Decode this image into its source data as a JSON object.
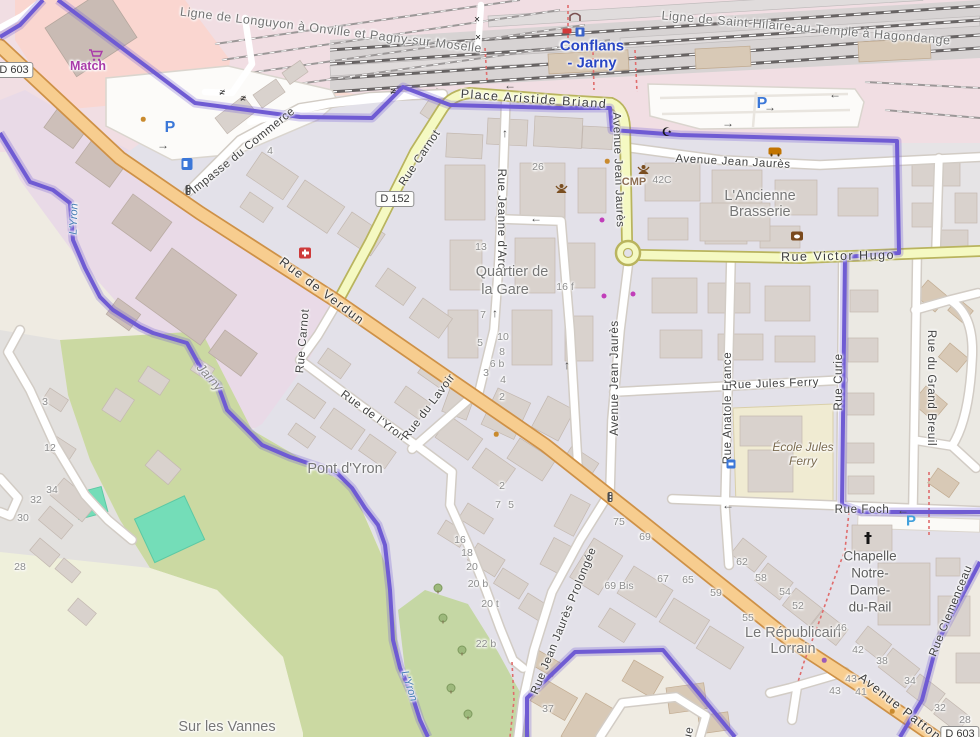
{
  "map": {
    "region": "Conflans-Jarny railway station area",
    "colors": {
      "boundary": "#6F5BD3",
      "primary_road": "#F7CD8F",
      "secondary_road": "#F5F9C2",
      "residential": "#E3E1E9",
      "industrial": "#E9DAE7",
      "retail_pink": "#FAD6D0",
      "scrub": "#CBD9A2",
      "pitch": "#74DDB8",
      "water_label": "#4A80B5",
      "station_name": "#2946C4",
      "parking": "#3B77D8"
    },
    "labels": [
      {
        "t": "Ligne de Longuyon à Onville et Pagny-sur-Moselle",
        "x": 331,
        "y": 30,
        "r": 7,
        "c": "rail"
      },
      {
        "t": "Ligne de Saint-Hilaire-au-Temple à Hagondange",
        "x": 806,
        "y": 28,
        "r": 5,
        "c": "rail"
      },
      {
        "t": "Conflans",
        "x": 592,
        "y": 46,
        "r": 0,
        "c": "station"
      },
      {
        "t": "- Jarny",
        "x": 592,
        "y": 63,
        "r": 0,
        "c": "station"
      },
      {
        "t": "Place Aristide Briand",
        "x": 534,
        "y": 99,
        "r": 4,
        "c": "street-big"
      },
      {
        "t": "Avenue Jean Jaurès",
        "x": 733,
        "y": 162,
        "r": 3,
        "c": "street"
      },
      {
        "t": "Avenue Jean Jaurès",
        "x": 618,
        "y": 170,
        "r": 88,
        "c": "street"
      },
      {
        "t": "Avenue Jean Jaurès",
        "x": 615,
        "y": 378,
        "r": -90,
        "c": "street"
      },
      {
        "t": "Rue Victor Hugo",
        "x": 838,
        "y": 256,
        "r": -1,
        "c": "street-big"
      },
      {
        "t": "Rue Carnot",
        "x": 420,
        "y": 158,
        "r": -56,
        "c": "street"
      },
      {
        "t": "Rue Carnot",
        "x": 303,
        "y": 341,
        "r": -85,
        "c": "street"
      },
      {
        "t": "Rue de Verdun",
        "x": 322,
        "y": 291,
        "r": 37,
        "c": "street-big"
      },
      {
        "t": "Impasse du Commerce",
        "x": 243,
        "y": 151,
        "r": -39,
        "c": "street"
      },
      {
        "t": "Rue Jeanne d'Arc",
        "x": 501,
        "y": 219,
        "r": 90,
        "c": "street"
      },
      {
        "t": "Rue de l'Yron",
        "x": 373,
        "y": 416,
        "r": 36,
        "c": "street"
      },
      {
        "t": "Rue du Lavoir",
        "x": 429,
        "y": 407,
        "r": -53,
        "c": "street"
      },
      {
        "t": "Rue Jean Jaurès Prolongée",
        "x": 564,
        "y": 621,
        "r": -68,
        "c": "street"
      },
      {
        "t": "Rue Jules Ferry",
        "x": 774,
        "y": 384,
        "r": -2,
        "c": "street"
      },
      {
        "t": "Rue Anatole France",
        "x": 728,
        "y": 408,
        "r": -90,
        "c": "street"
      },
      {
        "t": "Rue du Grand Breuil",
        "x": 931,
        "y": 388,
        "r": 90,
        "c": "street"
      },
      {
        "t": "Rue Curie",
        "x": 839,
        "y": 382,
        "r": -90,
        "c": "street"
      },
      {
        "t": "Rue Foch",
        "x": 862,
        "y": 510,
        "r": 0,
        "c": "street"
      },
      {
        "t": "Avenue Patton",
        "x": 900,
        "y": 707,
        "r": 38,
        "c": "street-big"
      },
      {
        "t": "Rue Clemenceau",
        "x": 951,
        "y": 611,
        "r": -68,
        "c": "street"
      },
      {
        "t": "Rue",
        "x": 688,
        "y": 738,
        "r": -78,
        "c": "street"
      },
      {
        "t": "Quartier de",
        "x": 512,
        "y": 272,
        "r": 0,
        "c": "place"
      },
      {
        "t": "la Gare",
        "x": 505,
        "y": 290,
        "r": 0,
        "c": "place"
      },
      {
        "t": "L'Ancienne",
        "x": 760,
        "y": 196,
        "r": 0,
        "c": "place"
      },
      {
        "t": "Brasserie",
        "x": 760,
        "y": 212,
        "r": 0,
        "c": "place"
      },
      {
        "t": "Pont d'Yron",
        "x": 345,
        "y": 469,
        "r": 0,
        "c": "place"
      },
      {
        "t": "Le Républicain",
        "x": 793,
        "y": 633,
        "r": 0,
        "c": "place"
      },
      {
        "t": "Lorrain",
        "x": 793,
        "y": 649,
        "r": 0,
        "c": "place"
      },
      {
        "t": "Sur les Vannes",
        "x": 227,
        "y": 727,
        "r": 0,
        "c": "place"
      },
      {
        "t": "École Jules",
        "x": 803,
        "y": 447,
        "r": 0,
        "c": "school"
      },
      {
        "t": "Ferry",
        "x": 803,
        "y": 461,
        "r": 0,
        "c": "school"
      },
      {
        "t": "Chapelle",
        "x": 870,
        "y": 556,
        "r": 0,
        "c": "chapel"
      },
      {
        "t": "Notre-",
        "x": 870,
        "y": 573,
        "r": 0,
        "c": "chapel"
      },
      {
        "t": "Dame-",
        "x": 870,
        "y": 590,
        "r": 0,
        "c": "chapel"
      },
      {
        "t": "du-Rail",
        "x": 870,
        "y": 607,
        "r": 0,
        "c": "chapel"
      },
      {
        "t": "Jarny",
        "x": 210,
        "y": 377,
        "r": 48,
        "c": "boundary-name"
      },
      {
        "t": "L'Yron",
        "x": 74,
        "y": 219,
        "r": -88,
        "c": "water"
      },
      {
        "t": "L'Yron",
        "x": 409,
        "y": 686,
        "r": 72,
        "c": "water"
      },
      {
        "t": "Match",
        "x": 88,
        "y": 66,
        "r": 0,
        "c": "shop-name"
      },
      {
        "t": "CMP",
        "x": 634,
        "y": 182,
        "r": 0,
        "c": "amenity-name"
      },
      {
        "t": "42C",
        "x": 662,
        "y": 180,
        "r": 0,
        "c": "num"
      },
      {
        "t": "4",
        "x": 270,
        "y": 151,
        "r": 0,
        "c": "num"
      },
      {
        "t": "26",
        "x": 538,
        "y": 167,
        "r": 0,
        "c": "num"
      },
      {
        "t": "13",
        "x": 481,
        "y": 247,
        "r": 0,
        "c": "num"
      },
      {
        "t": "16 f",
        "x": 565,
        "y": 287,
        "r": 0,
        "c": "num"
      },
      {
        "t": "7",
        "x": 483,
        "y": 315,
        "r": 0,
        "c": "num"
      },
      {
        "t": "10",
        "x": 503,
        "y": 337,
        "r": 0,
        "c": "num"
      },
      {
        "t": "5",
        "x": 480,
        "y": 343,
        "r": 0,
        "c": "num"
      },
      {
        "t": "8",
        "x": 502,
        "y": 352,
        "r": 0,
        "c": "num"
      },
      {
        "t": "6 b",
        "x": 497,
        "y": 364,
        "r": 0,
        "c": "num"
      },
      {
        "t": "3",
        "x": 486,
        "y": 373,
        "r": 0,
        "c": "num"
      },
      {
        "t": "4",
        "x": 503,
        "y": 380,
        "r": 0,
        "c": "num"
      },
      {
        "t": "2",
        "x": 502,
        "y": 397,
        "r": 0,
        "c": "num"
      },
      {
        "t": "2",
        "x": 502,
        "y": 486,
        "r": 0,
        "c": "num"
      },
      {
        "t": "7",
        "x": 498,
        "y": 505,
        "r": 0,
        "c": "num"
      },
      {
        "t": "5",
        "x": 511,
        "y": 505,
        "r": 0,
        "c": "num"
      },
      {
        "t": "16",
        "x": 460,
        "y": 540,
        "r": 0,
        "c": "num"
      },
      {
        "t": "18",
        "x": 467,
        "y": 553,
        "r": 0,
        "c": "num"
      },
      {
        "t": "20",
        "x": 472,
        "y": 567,
        "r": 0,
        "c": "num"
      },
      {
        "t": "20 b",
        "x": 478,
        "y": 584,
        "r": 0,
        "c": "num"
      },
      {
        "t": "20 t",
        "x": 490,
        "y": 604,
        "r": 0,
        "c": "num"
      },
      {
        "t": "22 b",
        "x": 486,
        "y": 644,
        "r": 0,
        "c": "num"
      },
      {
        "t": "37",
        "x": 548,
        "y": 709,
        "r": 0,
        "c": "num"
      },
      {
        "t": "75",
        "x": 619,
        "y": 522,
        "r": 0,
        "c": "num"
      },
      {
        "t": "69",
        "x": 645,
        "y": 537,
        "r": 0,
        "c": "num"
      },
      {
        "t": "69 Bis",
        "x": 619,
        "y": 586,
        "r": 0,
        "c": "num"
      },
      {
        "t": "67",
        "x": 663,
        "y": 579,
        "r": 0,
        "c": "num"
      },
      {
        "t": "65",
        "x": 688,
        "y": 580,
        "r": 0,
        "c": "num"
      },
      {
        "t": "62",
        "x": 742,
        "y": 562,
        "r": 0,
        "c": "num"
      },
      {
        "t": "58",
        "x": 761,
        "y": 578,
        "r": 0,
        "c": "num"
      },
      {
        "t": "54",
        "x": 785,
        "y": 592,
        "r": 0,
        "c": "num"
      },
      {
        "t": "59",
        "x": 716,
        "y": 593,
        "r": 0,
        "c": "num"
      },
      {
        "t": "52",
        "x": 798,
        "y": 606,
        "r": 0,
        "c": "num"
      },
      {
        "t": "55",
        "x": 748,
        "y": 618,
        "r": 0,
        "c": "num"
      },
      {
        "t": "46",
        "x": 841,
        "y": 628,
        "r": 0,
        "c": "num"
      },
      {
        "t": "42",
        "x": 858,
        "y": 650,
        "r": 0,
        "c": "num"
      },
      {
        "t": "38",
        "x": 882,
        "y": 661,
        "r": 0,
        "c": "num"
      },
      {
        "t": "34",
        "x": 910,
        "y": 681,
        "r": 0,
        "c": "num"
      },
      {
        "t": "43",
        "x": 851,
        "y": 679,
        "r": 0,
        "c": "num"
      },
      {
        "t": "43",
        "x": 835,
        "y": 691,
        "r": 0,
        "c": "num"
      },
      {
        "t": "41",
        "x": 861,
        "y": 692,
        "r": 0,
        "c": "num"
      },
      {
        "t": "32",
        "x": 940,
        "y": 708,
        "r": 0,
        "c": "num"
      },
      {
        "t": "28",
        "x": 965,
        "y": 720,
        "r": 0,
        "c": "num"
      },
      {
        "t": "3",
        "x": 45,
        "y": 402,
        "r": 0,
        "c": "num"
      },
      {
        "t": "12",
        "x": 50,
        "y": 448,
        "r": 0,
        "c": "num"
      },
      {
        "t": "34",
        "x": 52,
        "y": 490,
        "r": 0,
        "c": "num"
      },
      {
        "t": "32",
        "x": 36,
        "y": 500,
        "r": 0,
        "c": "num"
      },
      {
        "t": "30",
        "x": 23,
        "y": 518,
        "r": 0,
        "c": "num"
      },
      {
        "t": "28",
        "x": 20,
        "y": 567,
        "r": 0,
        "c": "num"
      },
      {
        "t": "D 603",
        "x": 14,
        "y": 70,
        "r": 0,
        "c": "shield"
      },
      {
        "t": "D 152",
        "x": 395,
        "y": 199,
        "r": 0,
        "c": "shield"
      },
      {
        "t": "D 603",
        "x": 960,
        "y": 734,
        "r": 0,
        "c": "shield"
      },
      {
        "t": "P",
        "x": 170,
        "y": 128,
        "r": 0,
        "c": "parking"
      },
      {
        "t": "P",
        "x": 762,
        "y": 104,
        "r": 0,
        "c": "parking"
      },
      {
        "t": "P",
        "x": 911,
        "y": 521,
        "r": 0,
        "c": "parking2"
      },
      {
        "t": "×",
        "x": 477,
        "y": 20,
        "r": 0,
        "c": "cross"
      },
      {
        "t": "×",
        "x": 478,
        "y": 38,
        "r": 0,
        "c": "cross"
      },
      {
        "t": "≠",
        "x": 222,
        "y": 93,
        "r": 15,
        "c": "cross"
      },
      {
        "t": "≠",
        "x": 243,
        "y": 99,
        "r": 15,
        "c": "cross"
      },
      {
        "t": "≠",
        "x": 393,
        "y": 92,
        "r": 10,
        "c": "cross"
      },
      {
        "t": "☪",
        "x": 667,
        "y": 132,
        "r": 0,
        "c": "poi-dark"
      },
      {
        "t": "↑",
        "x": 505,
        "y": 133,
        "r": 0,
        "c": "arrow"
      },
      {
        "t": "←",
        "x": 536,
        "y": 218,
        "r": 0,
        "c": "arrow"
      },
      {
        "t": "↑",
        "x": 495,
        "y": 313,
        "r": 0,
        "c": "arrow"
      },
      {
        "t": "↑",
        "x": 567,
        "y": 365,
        "r": 0,
        "c": "arrow"
      },
      {
        "t": "←",
        "x": 510,
        "y": 85,
        "r": 0,
        "c": "arrow"
      },
      {
        "t": "←",
        "x": 835,
        "y": 94,
        "r": 0,
        "c": "arrow"
      },
      {
        "t": "→",
        "x": 770,
        "y": 107,
        "r": 0,
        "c": "arrow"
      },
      {
        "t": "→",
        "x": 728,
        "y": 123,
        "r": 0,
        "c": "arrow"
      },
      {
        "t": "→",
        "x": 163,
        "y": 145,
        "r": 0,
        "c": "arrow"
      },
      {
        "t": "←",
        "x": 728,
        "y": 505,
        "r": 0,
        "c": "arrow"
      },
      {
        "t": "←",
        "x": 903,
        "y": 510,
        "r": 0,
        "c": "arrow"
      }
    ],
    "icons": [
      {
        "n": "fuel-icon",
        "x": 187,
        "y": 164
      },
      {
        "n": "first-aid-icon",
        "x": 305,
        "y": 253
      },
      {
        "n": "traffic-light-icon",
        "x": 188,
        "y": 190
      },
      {
        "n": "traffic-light-icon",
        "x": 610,
        "y": 497
      },
      {
        "n": "bus-stop-icon",
        "x": 731,
        "y": 464
      },
      {
        "n": "community-centre-icon",
        "x": 555,
        "y": 182
      },
      {
        "n": "community-centre-icon",
        "x": 637,
        "y": 163
      },
      {
        "n": "car-shop-icon",
        "x": 775,
        "y": 151
      },
      {
        "n": "attraction-icon",
        "x": 797,
        "y": 236
      },
      {
        "n": "church-cross-icon",
        "x": 868,
        "y": 538
      },
      {
        "n": "footbridge-icon",
        "x": 568,
        "y": 12
      },
      {
        "n": "rail-box-icon",
        "x": 567,
        "y": 31
      },
      {
        "n": "station-icon",
        "x": 580,
        "y": 32
      },
      {
        "n": "shopping-cart-icon",
        "x": 88,
        "y": 49
      },
      {
        "n": "shop-dot-icon",
        "x": 602,
        "y": 220
      },
      {
        "n": "shop-dot-icon",
        "x": 604,
        "y": 296
      },
      {
        "n": "shop-dot-icon",
        "x": 633,
        "y": 294
      },
      {
        "n": "poi-dot-orange-icon",
        "x": 607,
        "y": 161
      },
      {
        "n": "poi-dot-orange-icon",
        "x": 496,
        "y": 434
      },
      {
        "n": "poi-dot-orange-icon",
        "x": 892,
        "y": 711
      },
      {
        "n": "poi-dot-orange-icon",
        "x": 143,
        "y": 119
      },
      {
        "n": "poi-dot-purple-icon",
        "x": 824,
        "y": 660
      },
      {
        "n": "tree-icon",
        "x": 438,
        "y": 588
      },
      {
        "n": "tree-icon",
        "x": 443,
        "y": 618
      },
      {
        "n": "tree-icon",
        "x": 462,
        "y": 650
      },
      {
        "n": "tree-icon",
        "x": 451,
        "y": 688
      },
      {
        "n": "tree-icon",
        "x": 468,
        "y": 714
      }
    ]
  }
}
